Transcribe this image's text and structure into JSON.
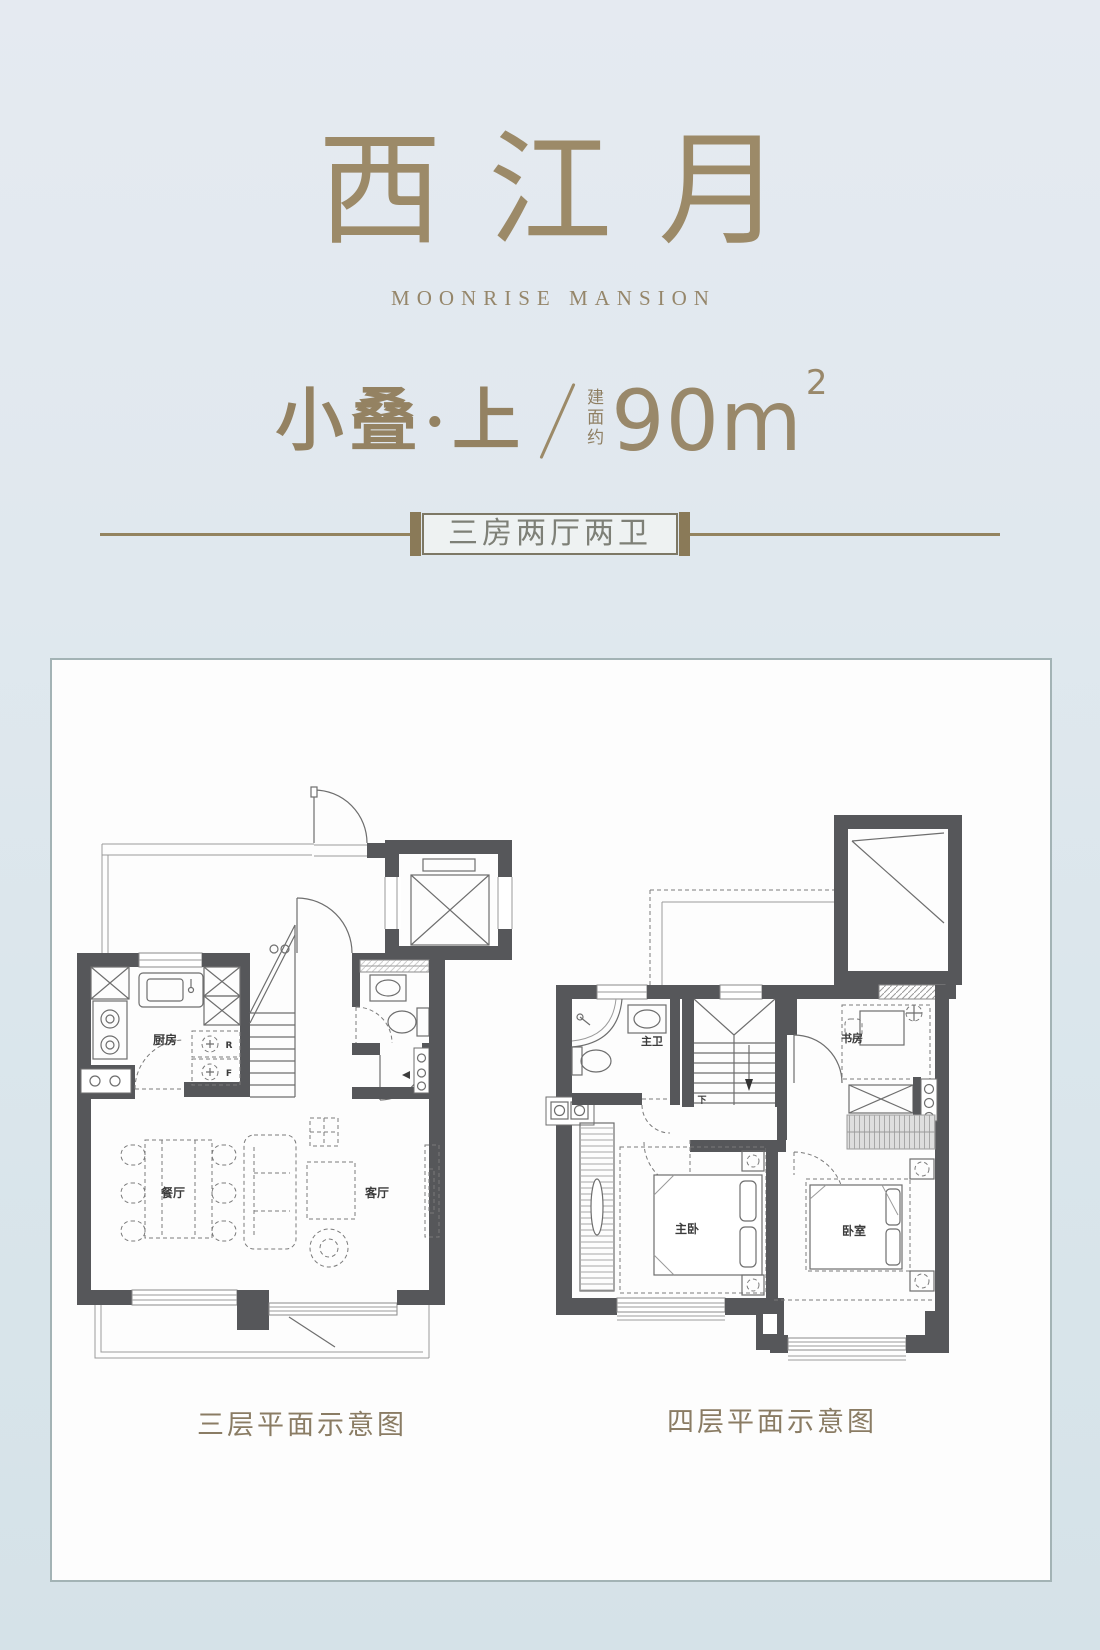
{
  "colors": {
    "accent_gold": "#9c8a68",
    "cap_gold": "#8a7a58",
    "badge_text": "#7e8077",
    "caption_text": "#8a7c64",
    "wall_gray": "#56575a",
    "panel_border": "#a3b3b5",
    "background_blue": "#dbe6ec"
  },
  "header": {
    "title": "西江月",
    "subtitle": "MOONRISE MANSION",
    "unit_label": "小叠·上",
    "area_prefix": "建面约",
    "area_value": "90m",
    "area_exponent": "2",
    "badge_label": "三房两厅两卫"
  },
  "plans": {
    "floor3": {
      "caption": "三层平面示意图",
      "labels": {
        "kitchen": "厨房",
        "dining": "餐厅",
        "living": "客厅",
        "fridge": "R",
        "freezer": "F"
      }
    },
    "floor4": {
      "caption": "四层平面示意图",
      "labels": {
        "master_bath": "主卫",
        "study": "书房",
        "master_bedroom": "主卧",
        "bedroom": "卧室",
        "stairs_down": "下"
      }
    }
  }
}
